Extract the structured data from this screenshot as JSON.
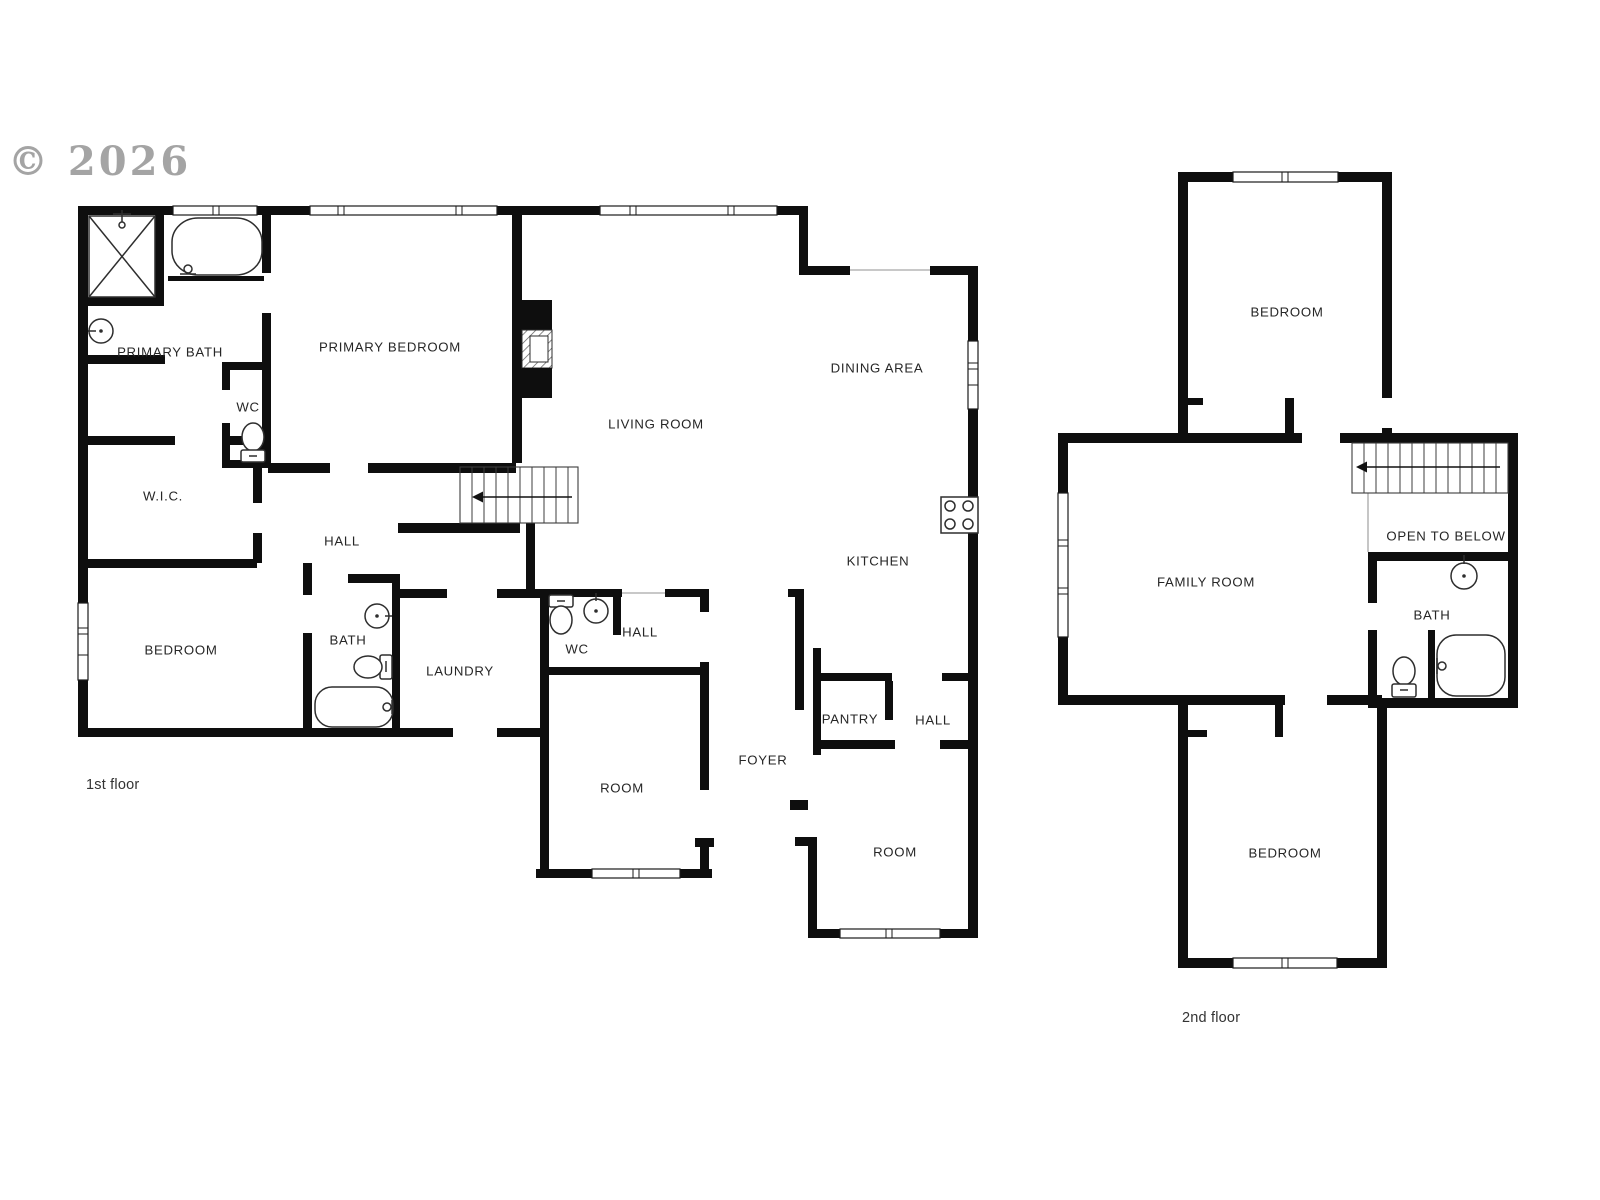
{
  "watermark": {
    "text": "© 2026",
    "color": "#9b9b9b"
  },
  "floor_plans": [
    {
      "floor_label": "1st floor",
      "label_x": 86,
      "label_y": 789,
      "rooms": [
        {
          "label": "PRIMARY BATH",
          "x": 170,
          "y": 352
        },
        {
          "label": "WC",
          "x": 248,
          "y": 407
        },
        {
          "label": "PRIMARY BEDROOM",
          "x": 390,
          "y": 347
        },
        {
          "label": "LIVING ROOM",
          "x": 656,
          "y": 424
        },
        {
          "label": "DINING AREA",
          "x": 877,
          "y": 368
        },
        {
          "label": "KITCHEN",
          "x": 878,
          "y": 561
        },
        {
          "label": "W.I.C.",
          "x": 163,
          "y": 496
        },
        {
          "label": "HALL",
          "x": 342,
          "y": 541
        },
        {
          "label": "BEDROOM",
          "x": 181,
          "y": 650
        },
        {
          "label": "BATH",
          "x": 348,
          "y": 640
        },
        {
          "label": "LAUNDRY",
          "x": 460,
          "y": 671
        },
        {
          "label": "WC",
          "x": 577,
          "y": 649
        },
        {
          "label": "HALL",
          "x": 640,
          "y": 632
        },
        {
          "label": "ROOM",
          "x": 622,
          "y": 788
        },
        {
          "label": "FOYER",
          "x": 763,
          "y": 760
        },
        {
          "label": "PANTRY",
          "x": 850,
          "y": 719
        },
        {
          "label": "HALL",
          "x": 933,
          "y": 720
        },
        {
          "label": "ROOM",
          "x": 895,
          "y": 852
        }
      ],
      "icons": [
        "shower-icon",
        "bathtub-icon",
        "sink-icon",
        "toilet-icon",
        "fireplace-icon",
        "stairs-icon",
        "stove-icon",
        "window-icon"
      ]
    },
    {
      "floor_label": "2nd floor",
      "label_x": 1182,
      "label_y": 1022,
      "rooms": [
        {
          "label": "BEDROOM",
          "x": 1287,
          "y": 312
        },
        {
          "label": "OPEN TO BELOW",
          "x": 1446,
          "y": 536
        },
        {
          "label": "FAMILY ROOM",
          "x": 1206,
          "y": 582
        },
        {
          "label": "BATH",
          "x": 1432,
          "y": 615
        },
        {
          "label": "BEDROOM",
          "x": 1285,
          "y": 853
        }
      ],
      "icons": [
        "stairs-icon",
        "sink-icon",
        "toilet-icon",
        "bathtub-icon",
        "window-icon"
      ]
    }
  ]
}
